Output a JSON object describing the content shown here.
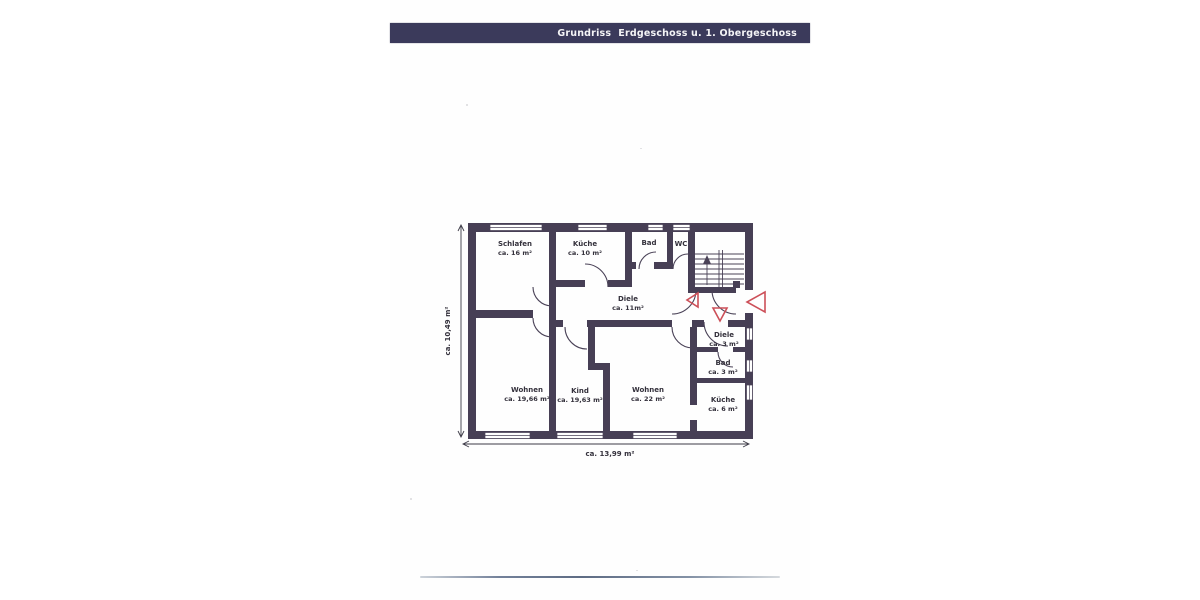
{
  "header": {
    "title": "Grundriss  Erdgeschoss u. 1. Obergeschoss",
    "bg_color": "#3b3a5b",
    "text_color": "#f4f4f6"
  },
  "floor_plan": {
    "wall_color": "#473f55",
    "line_color": "#4a4257",
    "marker_color": "#cc4f58",
    "rooms": [
      {
        "name": "Schlafen",
        "area": "ca. 16 m²"
      },
      {
        "name": "Küche",
        "area": "ca. 10 m²"
      },
      {
        "name": "Bad"
      },
      {
        "name": "WC"
      },
      {
        "name": "Diele",
        "area": "ca. 11m²"
      },
      {
        "name": "Wohnen",
        "area": "ca. 19,66 m²"
      },
      {
        "name": "Kind",
        "area": "ca. 19,63 m²"
      },
      {
        "name": "Wohnen",
        "area": "ca. 22 m²"
      },
      {
        "name": "Diele",
        "area": "ca. 3 m²"
      },
      {
        "name": "Bad",
        "area": "ca. 3 m²"
      },
      {
        "name": "Küche",
        "area": "ca. 6 m²"
      }
    ],
    "dimensions": {
      "height": "ca. 10,49 m²",
      "width": "ca. 13,99 m²"
    }
  }
}
